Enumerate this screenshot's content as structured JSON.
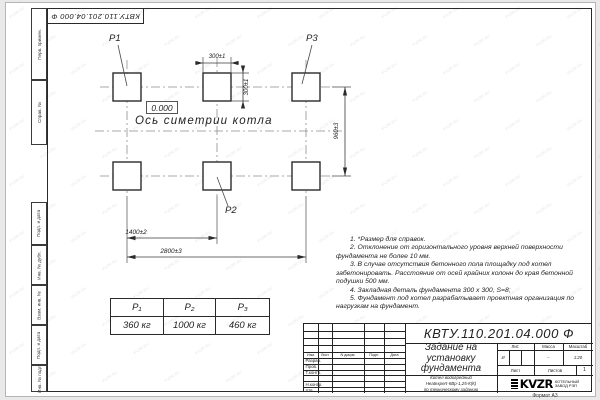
{
  "watermark": {
    "text": "KVZR.RU"
  },
  "stamp": {
    "doc_number_inverted": "КВТУ.110.201.04.000  Ф"
  },
  "margin_labels": {
    "perv_primen": "Перв. примен.",
    "sprav_no": "Справ. №",
    "podp_data_1": "Подп. и дата",
    "inv_dubl": "Инв. № дубл.",
    "vzam_inv": "Взам. инв. №",
    "podp_data_2": "Подп. и дата",
    "inv_podl": "Инв. № подл."
  },
  "drawing": {
    "p1": "P1",
    "p2": "P2",
    "p3": "P3",
    "level_mark": "0.000",
    "axis_label": "Ось симетрии котла",
    "dim_top_width": "300±1",
    "dim_top_height": "300±1",
    "dim_row_spacing": "960±3",
    "dim_col_spacing": "1400±2",
    "dim_total_width": "2800±3"
  },
  "loads_table": {
    "headers": [
      "P₁",
      "P₂",
      "P₃"
    ],
    "values": [
      "360 кг",
      "1000 кг",
      "460 кг"
    ]
  },
  "notes": [
    "1.  *Размер для справок.",
    "2.  Отклонение от горизонтального уровня верхней поверхности фундамента не более 10 мм.",
    "3.  В случае отсутствия бетонного пола площадку под котел забетонировать. Расстояние от осей крайних колонн до края бетонной подушки 500 мм.",
    "4.  Закладная деталь фундамента  300 х 300, S=8;",
    "5.  Фундамент под котел разрабатывает проектная организация по нагрузкам на фундамент."
  ],
  "title_block": {
    "doc_number": "КВТУ.110.201.04.000  Ф",
    "title": "Задание на\nустановку\nфундамента",
    "subtitle": "Котел водогрейный\nHeatexpert-КВр-1,25-К(К)\nпо техническому заданию",
    "header_cols": [
      "Изм.",
      "Лист",
      "N докум.",
      "Подп.",
      "Дата"
    ],
    "sign_rows": [
      "Разраб.",
      "Пров.",
      "Т.контр.",
      "",
      "Н.контр.",
      "Утв."
    ],
    "lit_header": "Лит.",
    "mass_header": "Масса",
    "scale_header": "Масштаб",
    "lit_value": "И",
    "mass_value": "–",
    "scale_value": "1:20",
    "sheet_label": "Лист",
    "sheets_label": "Листов",
    "sheets_value": "1",
    "logo_text": "KVZR",
    "logo_caption": "КОТЕЛЬНЫЙ\nЗАВОД РЭП",
    "format_label": "Формат А3"
  }
}
